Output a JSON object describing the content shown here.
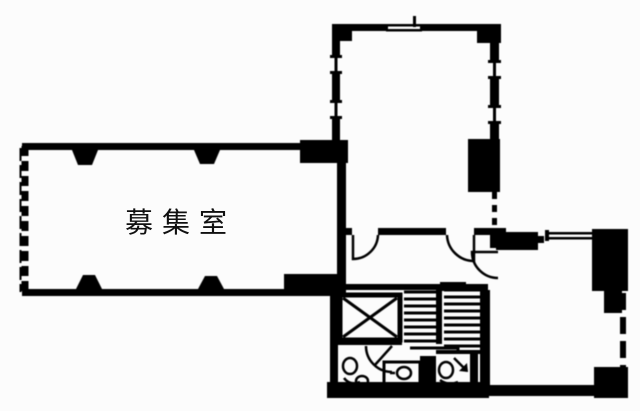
{
  "colors": {
    "paper": "#fcfcfc",
    "ink": "#101010"
  },
  "rooms": {
    "left_room": {
      "label": "募集室"
    }
  },
  "features": {
    "elevator_icon": "crossed-box-elevator",
    "stairs_icon": "parallel-tread-staircase",
    "direction_arrow_icon": "down-right-arrow",
    "door_icon": "quarter-circle-door-swing",
    "window_icon": "double-line-window",
    "column_icon": "solid-black-column"
  }
}
